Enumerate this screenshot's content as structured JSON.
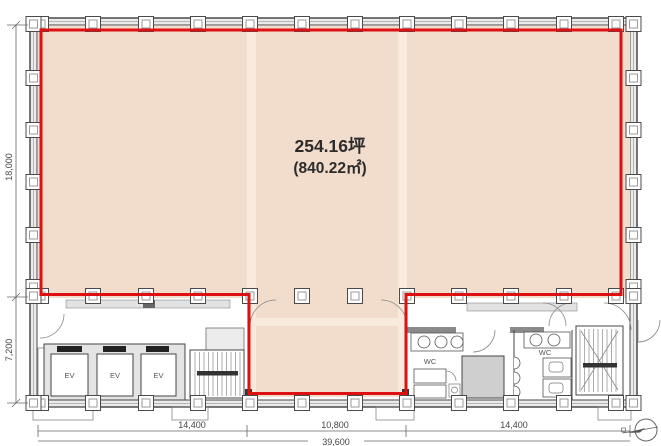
{
  "plan": {
    "title": "office-floor-plan",
    "area_label": {
      "tsubo": "254.16坪",
      "sqm": "(840.22㎡)"
    },
    "rooms": {
      "elevators": [
        "EV",
        "EV",
        "EV"
      ],
      "toilets": [
        "WC",
        "WC"
      ]
    },
    "dimensions": {
      "left_upper": "18,000",
      "left_lower": "7,200",
      "bottom_left": "14,400",
      "bottom_center": "10,800",
      "bottom_right": "14,400",
      "bottom_total": "39,600"
    },
    "icons": {
      "north_arrow": "compass-circle-with-arrow"
    },
    "colors": {
      "leasable_fill": "#f2ddcd",
      "grid_band": "#f8eadd",
      "boundary_red": "#dd1111",
      "line": "#4a4a4a"
    }
  }
}
